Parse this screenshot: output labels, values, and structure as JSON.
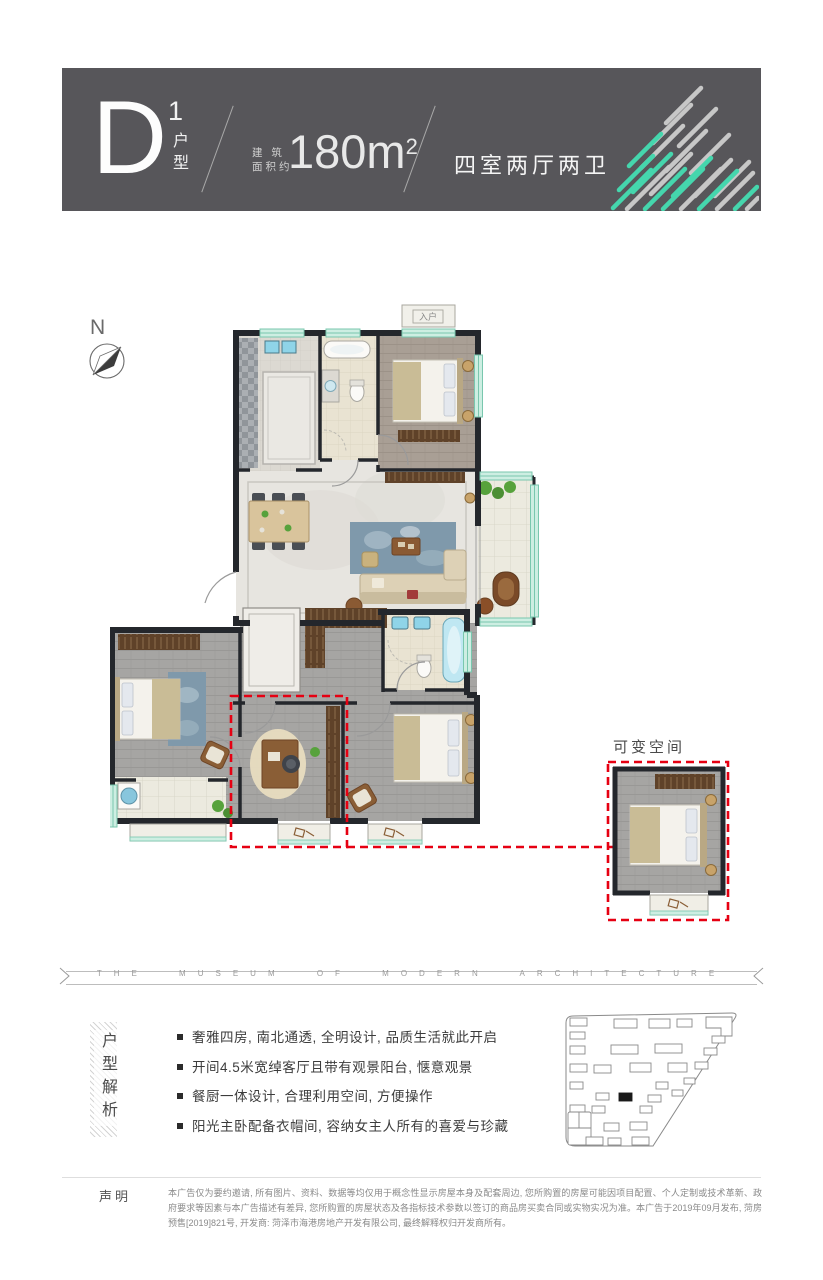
{
  "header": {
    "unit_letter": "D",
    "unit_number": "1",
    "unit_label": "户型",
    "area_label1": "建 筑",
    "area_label2": "面积约",
    "area_value": "180m",
    "area_exp": "2",
    "layout_text": "四室两厅两卫",
    "bg_color": "#57565a",
    "accent_color": "#45d6ad",
    "stripe_gray": "#c7c7c7"
  },
  "plan": {
    "north_label": "N",
    "entry_label": "入户",
    "variable_label": "可变空间",
    "highlight_color": "#e60012"
  },
  "ribbon": {
    "text": "THE MUSEUM OF MODERN ARCHITECTURE"
  },
  "analysis": {
    "title": "户型解析",
    "bullets": [
      "奢雅四房, 南北通透, 全明设计, 品质生活就此开启",
      "开间4.5米宽绰客厅且带有观景阳台, 惬意观景",
      "餐厨一体设计, 合理利用空间, 方便操作",
      "阳光主卧配备衣帽间, 容纳女主人所有的喜爱与珍藏"
    ]
  },
  "disclaimer": {
    "label": "声明",
    "text": "本广告仅为要约邀请, 所有图片、资料、数据等均仅用于概念性显示房屋本身及配套周边, 您所购置的房屋可能因项目配置、个人定制或技术革新、政府要求等因素与本广告描述有差异, 您所购置的房屋状态及各指标技术参数以签订的商品房买卖合同或实物实况为准。本广告于2019年09月发布, 菏房预售[2019]821号, 开发商: 菏泽市海港房地产开发有限公司, 最终解释权归开发商所有。"
  }
}
